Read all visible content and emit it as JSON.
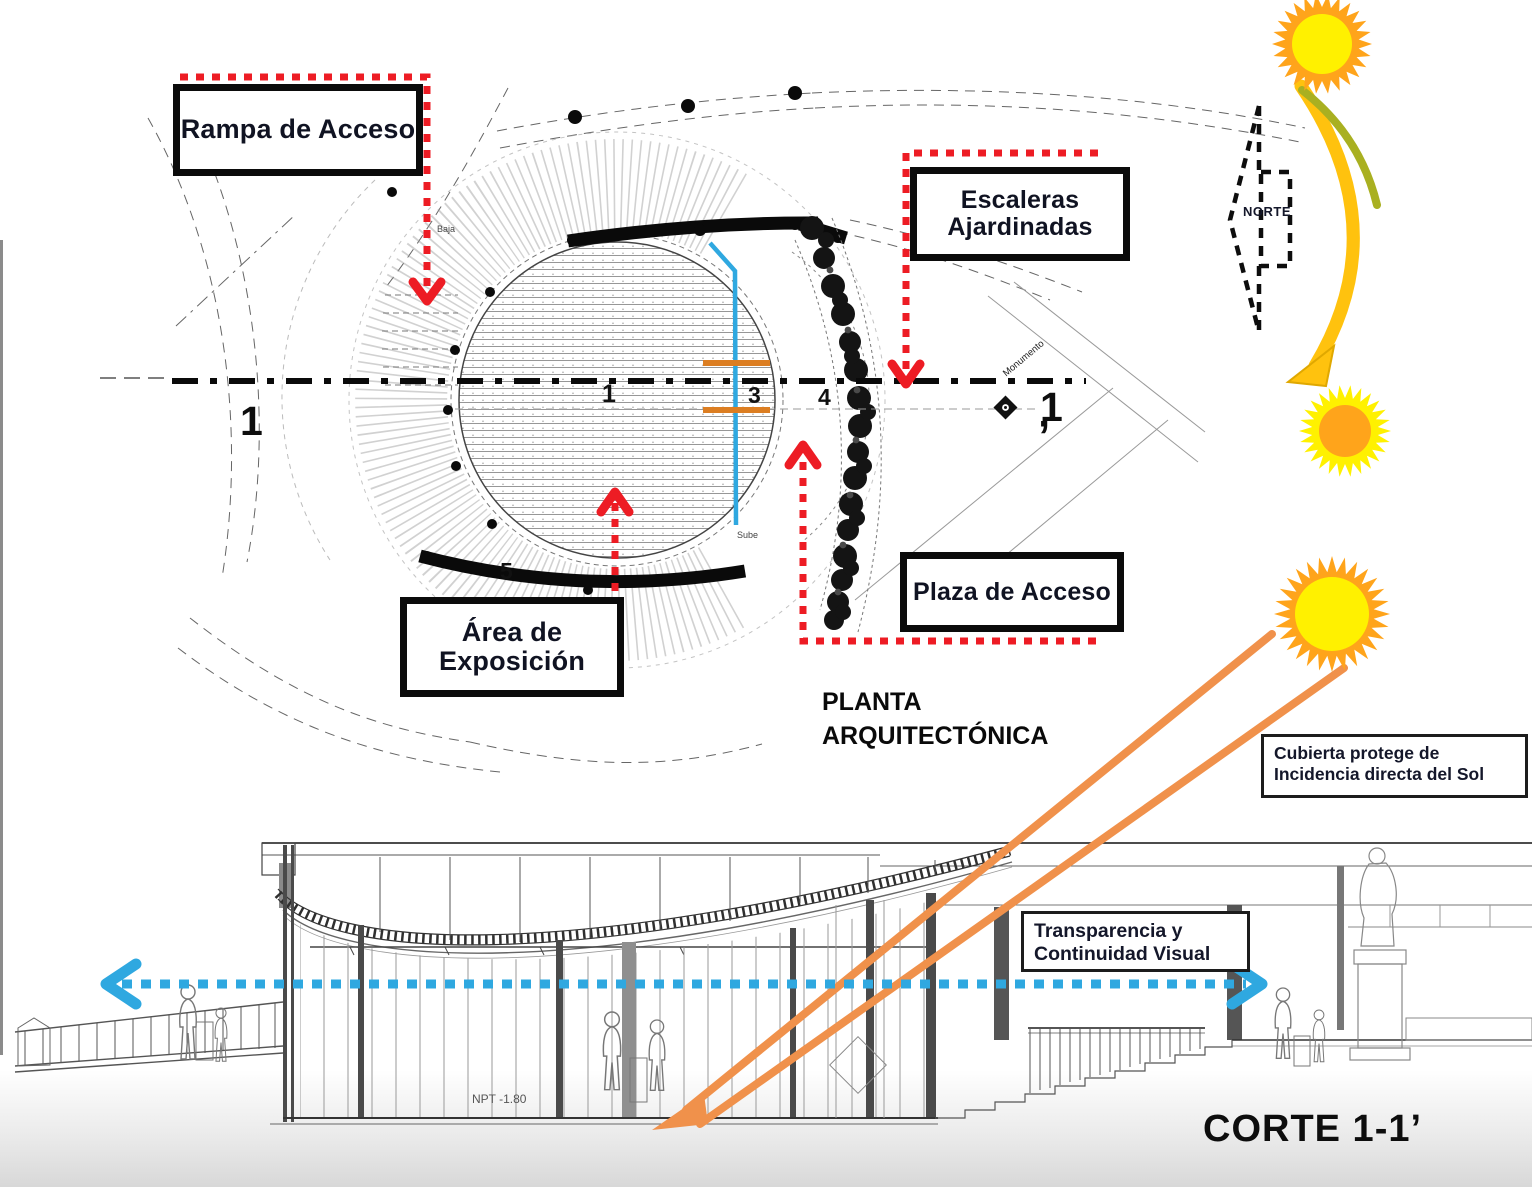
{
  "plan": {
    "title": "PLANTA ARQUITECTÓNICA",
    "callout_rampa": "Rampa de Acceso",
    "callout_escaleras": "Escaleras Ajardinadas",
    "callout_area": "Área de Exposición",
    "callout_plaza": "Plaza de Acceso",
    "mark_left": "1",
    "mark_right": "1",
    "mark_right_prime": "’",
    "grid_1": "1",
    "grid_3": "3",
    "grid_4": "4",
    "grid_5": "5",
    "note_baja": "Baja",
    "note_sube": "Sube",
    "note_monumento": "Monumento"
  },
  "north": {
    "label": "NORTE"
  },
  "section": {
    "title": "CORTE 1-1’",
    "note_cubierta": "Cubierta protege de Incidencia directa del Sol",
    "note_transparencia": "Transparencia y Continuidad Visual",
    "level_npt": "NPT -1.80"
  },
  "colors": {
    "red": "#ED1C24",
    "blue": "#2FA8E0",
    "orange": "#F0914B",
    "orange_dark": "#DC7E22",
    "yellow": "#FFC20E",
    "olive": "#A9B021",
    "sun_orange": "#FFA41B",
    "sun_yellow": "#FFF100"
  }
}
